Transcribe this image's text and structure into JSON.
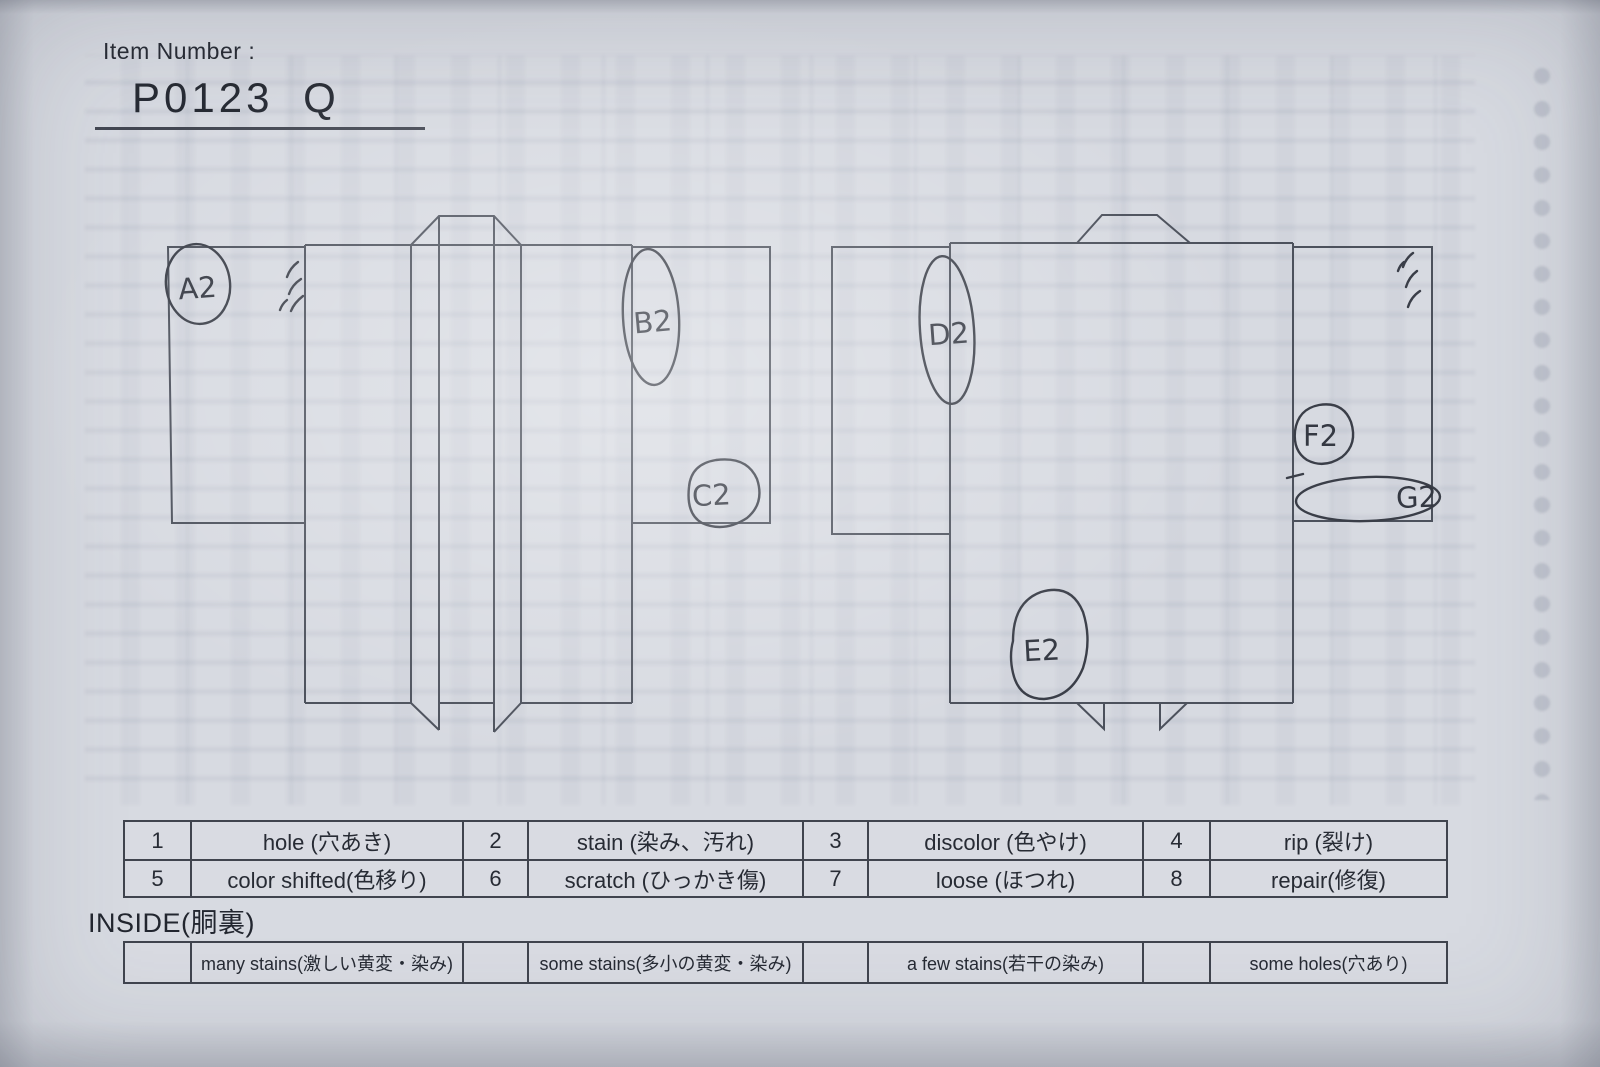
{
  "header": {
    "item_number_label": "Item Number :",
    "item_number_value": "P0123  Q"
  },
  "annotations": {
    "a2": "A2",
    "b2": "B2",
    "c2": "C2",
    "d2": "D2",
    "e2": "E2",
    "f2": "F2",
    "g2": "G2"
  },
  "legend_table": {
    "rows": [
      {
        "cells": [
          "1",
          "hole (穴あき)",
          "2",
          "stain (染み、汚れ)",
          "3",
          "discolor (色やけ)",
          "4",
          "rip (裂け)"
        ]
      },
      {
        "cells": [
          "5",
          "color shifted(色移り)",
          "6",
          "scratch (ひっかき傷)",
          "7",
          "loose (ほつれ)",
          "8",
          "repair(修復)"
        ]
      }
    ]
  },
  "inside_section": {
    "heading": "INSIDE(胴裏)",
    "row": {
      "cells": [
        "",
        "many stains(激しい黄変・染み)",
        "",
        "some stains(多小の黄変・染み)",
        "",
        "a few stains(若干の染み)",
        "",
        "some holes(穴あり)"
      ]
    }
  },
  "colors": {
    "paper": "#d7dae1",
    "diagram_line": "#4c515c",
    "pen": "#3a3e48",
    "text": "#272b34"
  }
}
